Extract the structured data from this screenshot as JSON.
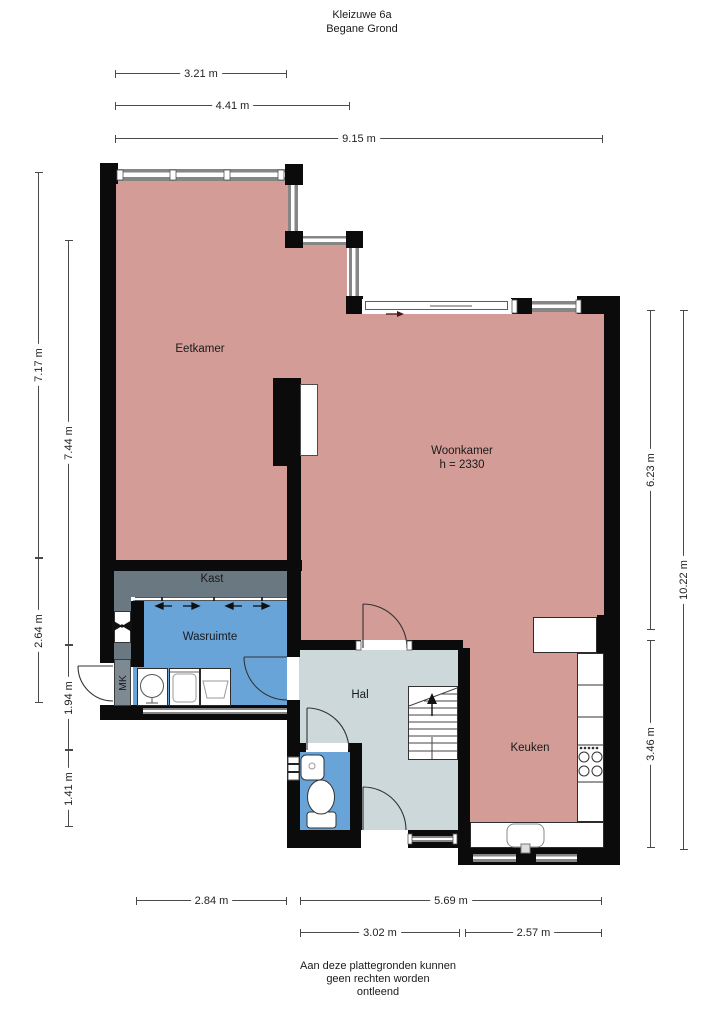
{
  "title": {
    "line1": "Kleizuwe 6a",
    "line2": "Begane Grond"
  },
  "rooms": {
    "eetkamer": "Eetkamer",
    "woonkamer": "Woonkamer",
    "woonkamer_height": "h = 2330",
    "kast": "Kast",
    "wasruimte": "Wasruimte",
    "hal": "Hal",
    "keuken": "Keuken",
    "meterkast": "MK"
  },
  "dimensions": {
    "top": [
      "3.21 m",
      "4.41 m",
      "9.15 m"
    ],
    "left": [
      "7.17 m",
      "7.44 m",
      "2.64 m",
      "1.94 m",
      "1.41 m"
    ],
    "right": [
      "6.23 m",
      "10.22 m",
      "3.46 m"
    ],
    "bottom": [
      "2.84 m",
      "5.69 m",
      "3.02 m",
      "2.57 m"
    ]
  },
  "footer": {
    "line1": "Aan deze plattegronden kunnen",
    "line2": "geen rechten worden",
    "line3": "ontleend"
  },
  "colors": {
    "living_floor": "#d39c96",
    "wet_room_floor": "#69a4d9",
    "hall_floor": "#ccd8d9",
    "closet_floor": "#6a7882",
    "meter_cupboard": "#7e8a91",
    "wall": "#0b0b0b",
    "window_frame": "#868686"
  }
}
